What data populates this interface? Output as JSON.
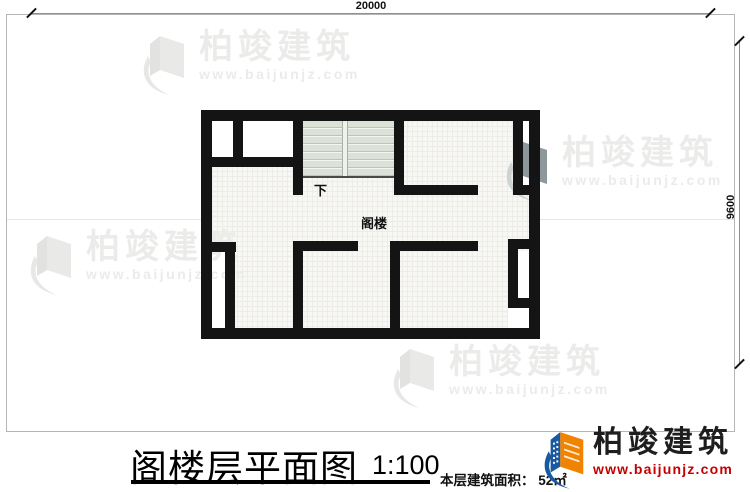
{
  "dimensions": {
    "width_mm": "20000",
    "depth_mm": "9600"
  },
  "plan_labels": {
    "stairs_down": "下",
    "attic": "阁楼"
  },
  "watermark": {
    "title": "柏竣建筑",
    "url": "www.baijunjz.com"
  },
  "title_block": {
    "drawing_title": "阁楼层平面图",
    "scale": "1:100",
    "area_label": "本层建筑面积：",
    "area_value": "52㎡"
  },
  "logo": {
    "name": "柏竣建筑",
    "url": "www.baijunjz.com"
  },
  "colors": {
    "wall": "#141414",
    "stair_fill": "#dce2d7",
    "logo_blue": "#19599f",
    "logo_orange": "#f08300",
    "logo_url_red": "#c40000"
  }
}
